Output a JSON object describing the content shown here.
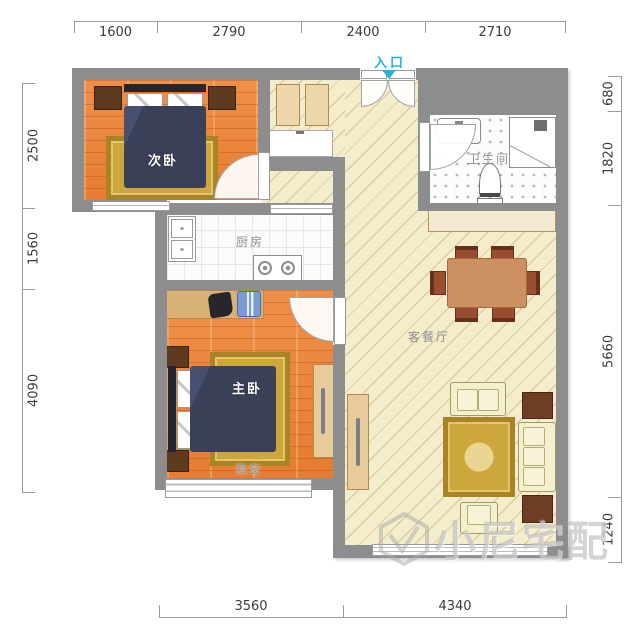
{
  "plan_title": "两室一厅户型图",
  "rooms": {
    "secondary_bedroom": "次卧",
    "master_bedroom": "主卧",
    "kitchen": "厨房",
    "bathroom": "卫生间",
    "living_dining": "客餐厅"
  },
  "labels": {
    "entrance": "入口",
    "bay_window": "飘窗"
  },
  "dimensions": {
    "top": [
      "1600",
      "2790",
      "2400",
      "2710"
    ],
    "bottom": [
      "3560",
      "4340"
    ],
    "left": [
      "2500",
      "1560",
      "4090"
    ],
    "right": [
      "680",
      "1820",
      "5660",
      "1240"
    ]
  },
  "watermark": "小尼宅配",
  "colors": {
    "wall": "#8d8d8d",
    "wood_floor": "#e8823c",
    "living_floor": "#f4ecca",
    "accent_entry": "#23b2d8",
    "rug_gold": "#cda73c",
    "bed_navy": "#3a4057",
    "dim_text": "#3c3c3c"
  }
}
